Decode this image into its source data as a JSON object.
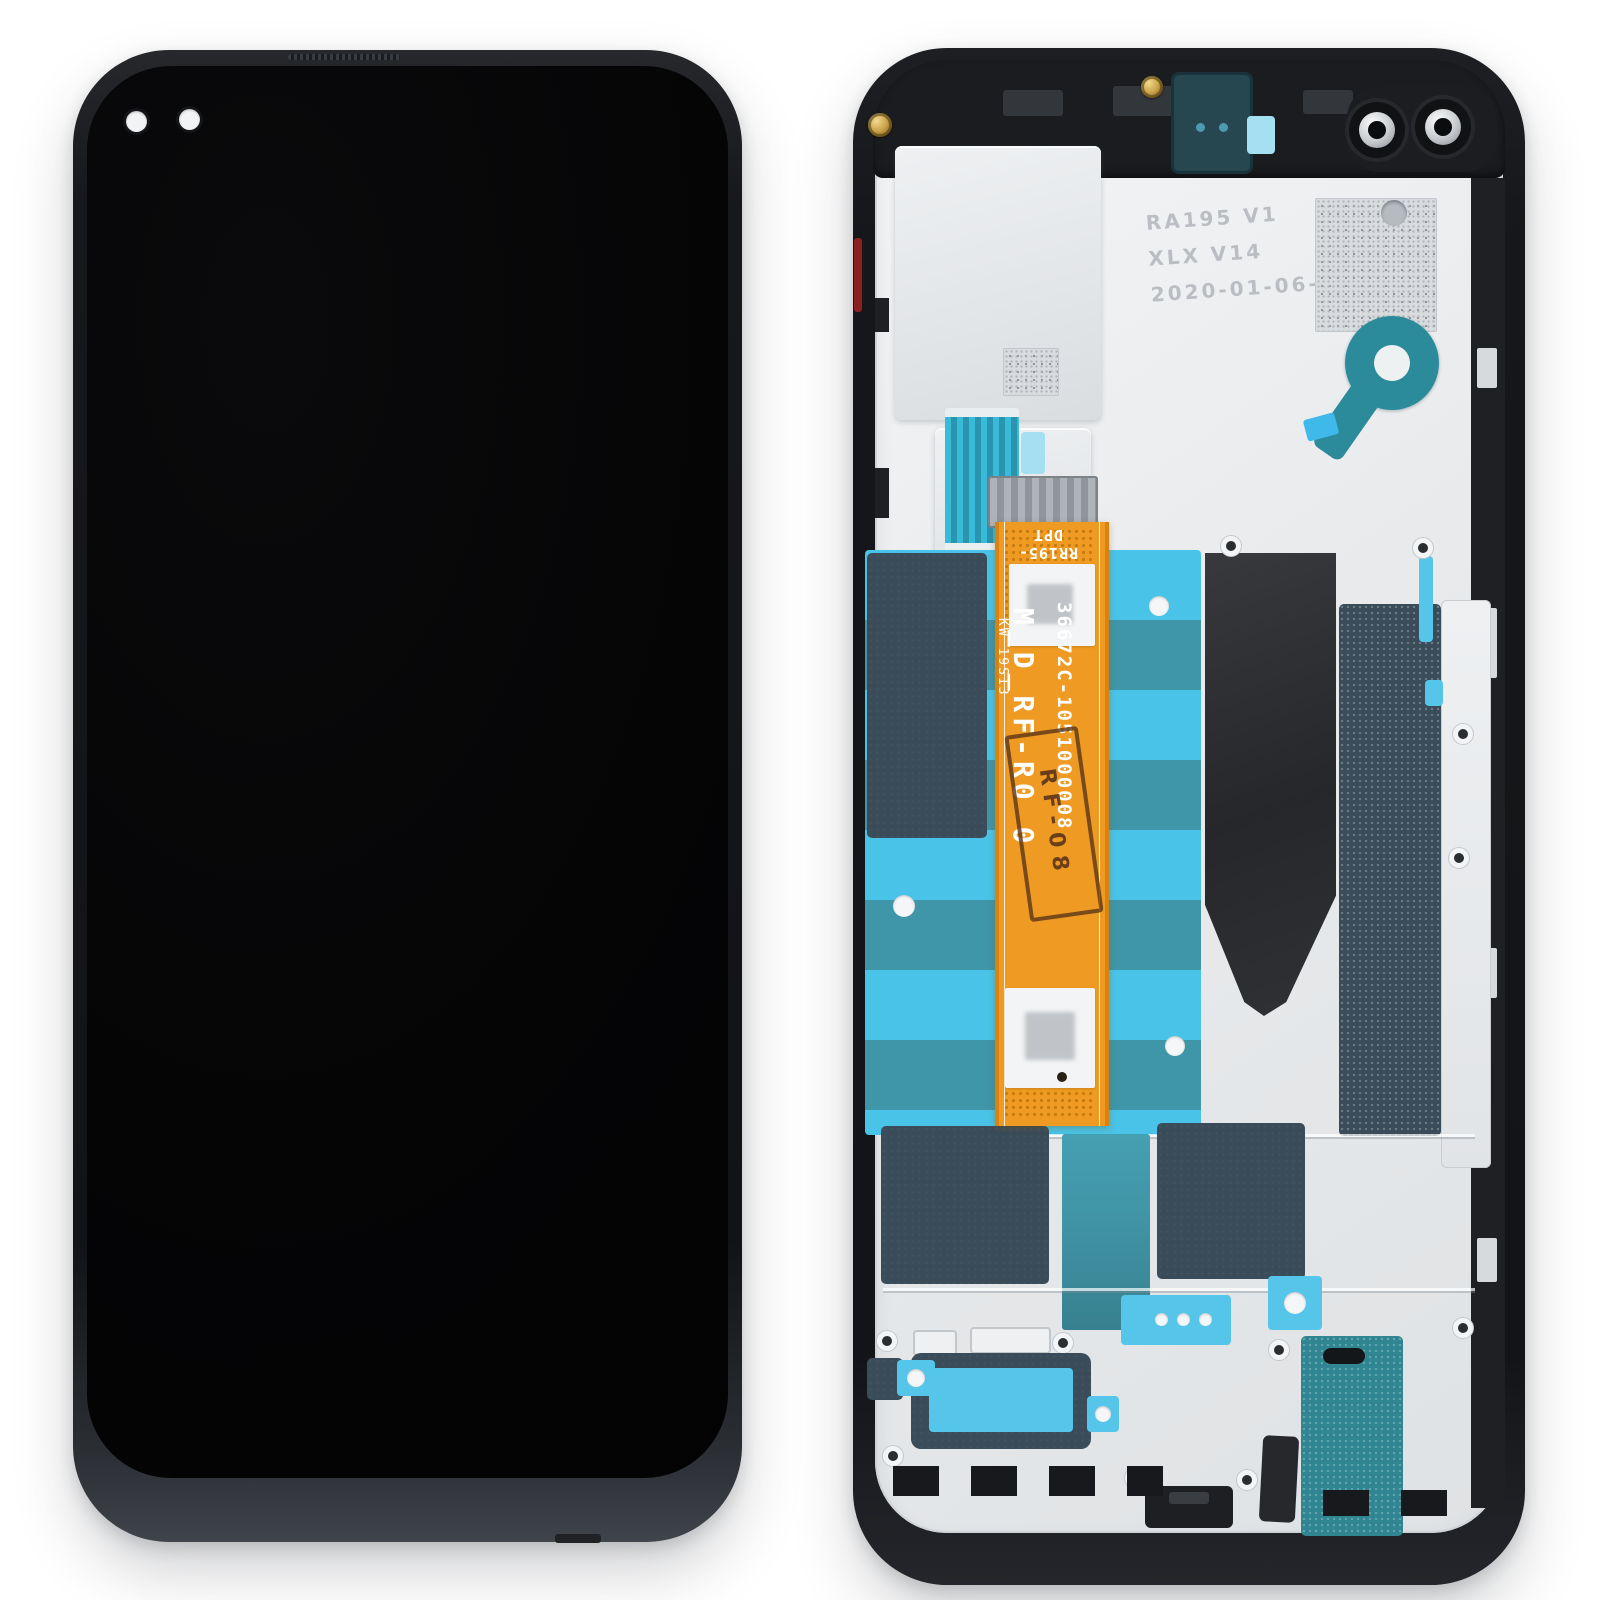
{
  "meta": {
    "subject": "Smartphone LCD screen and digitizer full assembly with frame — front view and rear view",
    "background_color": "#ffffff"
  },
  "front_view": {
    "frame_color": "#17181b",
    "screen_color": "#050506",
    "punch_hole_count": "2"
  },
  "back_view": {
    "frame_color": "#15171a",
    "chassis_color": "#e8eaec",
    "flex_cable": {
      "color": "#ef9a22",
      "part_number": "36672C-1051000008",
      "marking_large": "M_D_RF-R0 0",
      "marking_small": "KW 19S13",
      "connector_code": "RR195-DPT",
      "qc_stamp": "RF-08"
    },
    "etched_markings": {
      "line1": "RA195  V1",
      "line2": "XLX V14",
      "line3": "2020-01-06-8-55"
    },
    "colors": {
      "adhesive_cyan": "#49c3e7",
      "adhesive_teal": "#3f96a8",
      "insulator_slate": "#3a4c59",
      "mesh_teal": "#2f8591",
      "graphite": "#2b2d30",
      "screw_gold": "#cda54b",
      "side_button_red": "#8c2020"
    }
  }
}
